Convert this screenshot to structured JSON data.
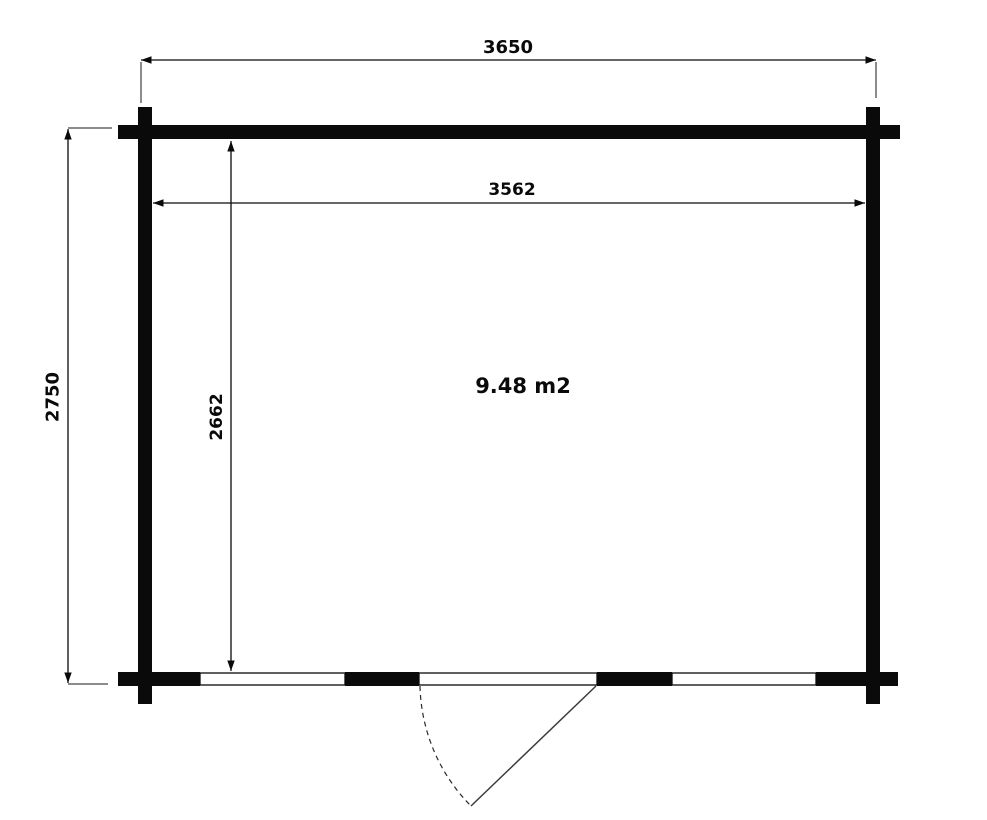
{
  "colors": {
    "ink": "#0a0a0a",
    "background": "#ffffff"
  },
  "plan": {
    "area_label": "9.48 m2",
    "outer_width_mm": "3650",
    "inner_width_mm": "3562",
    "outer_height_mm": "2750",
    "inner_height_mm": "2662"
  }
}
